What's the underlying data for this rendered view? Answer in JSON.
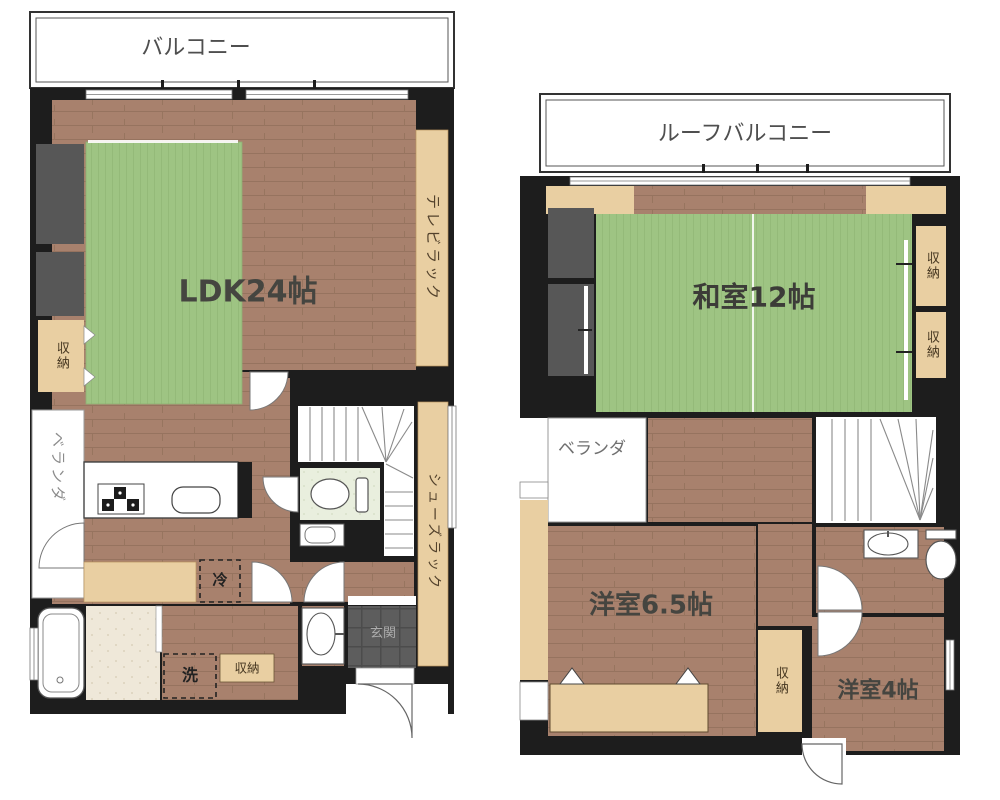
{
  "plan1": {
    "balcony": "バルコニー",
    "ldk": "LDK24帖",
    "tv_rack": "テレビラック",
    "storage_left": "収納",
    "veranda": "ベランダ",
    "fridge": "冷",
    "washer": "洗",
    "storage_bottom": "収納",
    "shoe_rack": "シューズラック",
    "entrance": "玄関"
  },
  "plan2": {
    "roof_balcony": "ルーフバルコニー",
    "washitsu": "和室12帖",
    "storage_right_top": "収納",
    "storage_right_bottom": "収納",
    "veranda": "ベランダ",
    "western_65": "洋室6.5帖",
    "storage_middle": "収納",
    "western_4": "洋室4帖"
  },
  "palette": {
    "wall_black": "#1d1d1d",
    "floor_wood": "#a8816d",
    "tatami_green": "#9ec483",
    "wood_tan": "#e9cfa2",
    "dark_unit_gray": "#575757",
    "entrance_tile": "#5d5d5d",
    "bath_floor": "#efe8d9",
    "toilet_floor": "#e9efde",
    "paper_white": "#ffffff"
  }
}
